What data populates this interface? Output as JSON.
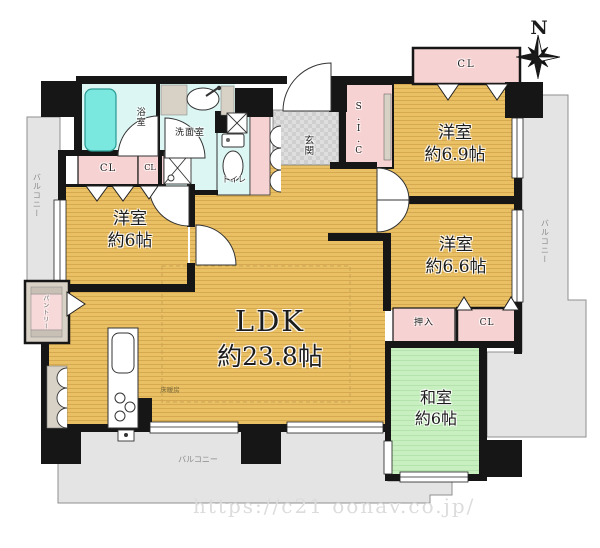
{
  "compass": {
    "north_label": "N"
  },
  "watermark": {
    "url_text": "https://c21 oonav.co.jp/"
  },
  "rooms": {
    "ldk": {
      "name": "LDK",
      "size": "約23.8帖"
    },
    "bedroom_69": {
      "name": "洋室",
      "size": "約6.9帖"
    },
    "bedroom_66": {
      "name": "洋室",
      "size": "約6.6帖"
    },
    "bedroom_6": {
      "name": "洋室",
      "size": "約6帖"
    },
    "japanese_room": {
      "name": "和室",
      "size": "約6帖"
    },
    "bath": {
      "name": "浴室"
    },
    "washroom": {
      "name": "洗面室"
    },
    "toilet": {
      "name": "トイレ"
    },
    "entrance": {
      "name": "玄関"
    },
    "shoe_closet": {
      "name": "S.I.C"
    },
    "pantry": {
      "name": "パントリー"
    }
  },
  "storage": {
    "closet_label": "CL",
    "oshiire_label": "押入"
  },
  "labels": {
    "balcony": "バルコニー",
    "floor_heating": "床暖房"
  },
  "palette": {
    "wood_floor": "#eac065",
    "tatami_green": "#c8efc0",
    "closet_pink": "#f7d2d2",
    "bath_cyan": "#dcf6f3",
    "bathtub_cyan": "#7be8e0",
    "balcony_gray": "#e4e4e4",
    "entrance_gray": "#d9d9d9",
    "wall_black": "#161616"
  }
}
